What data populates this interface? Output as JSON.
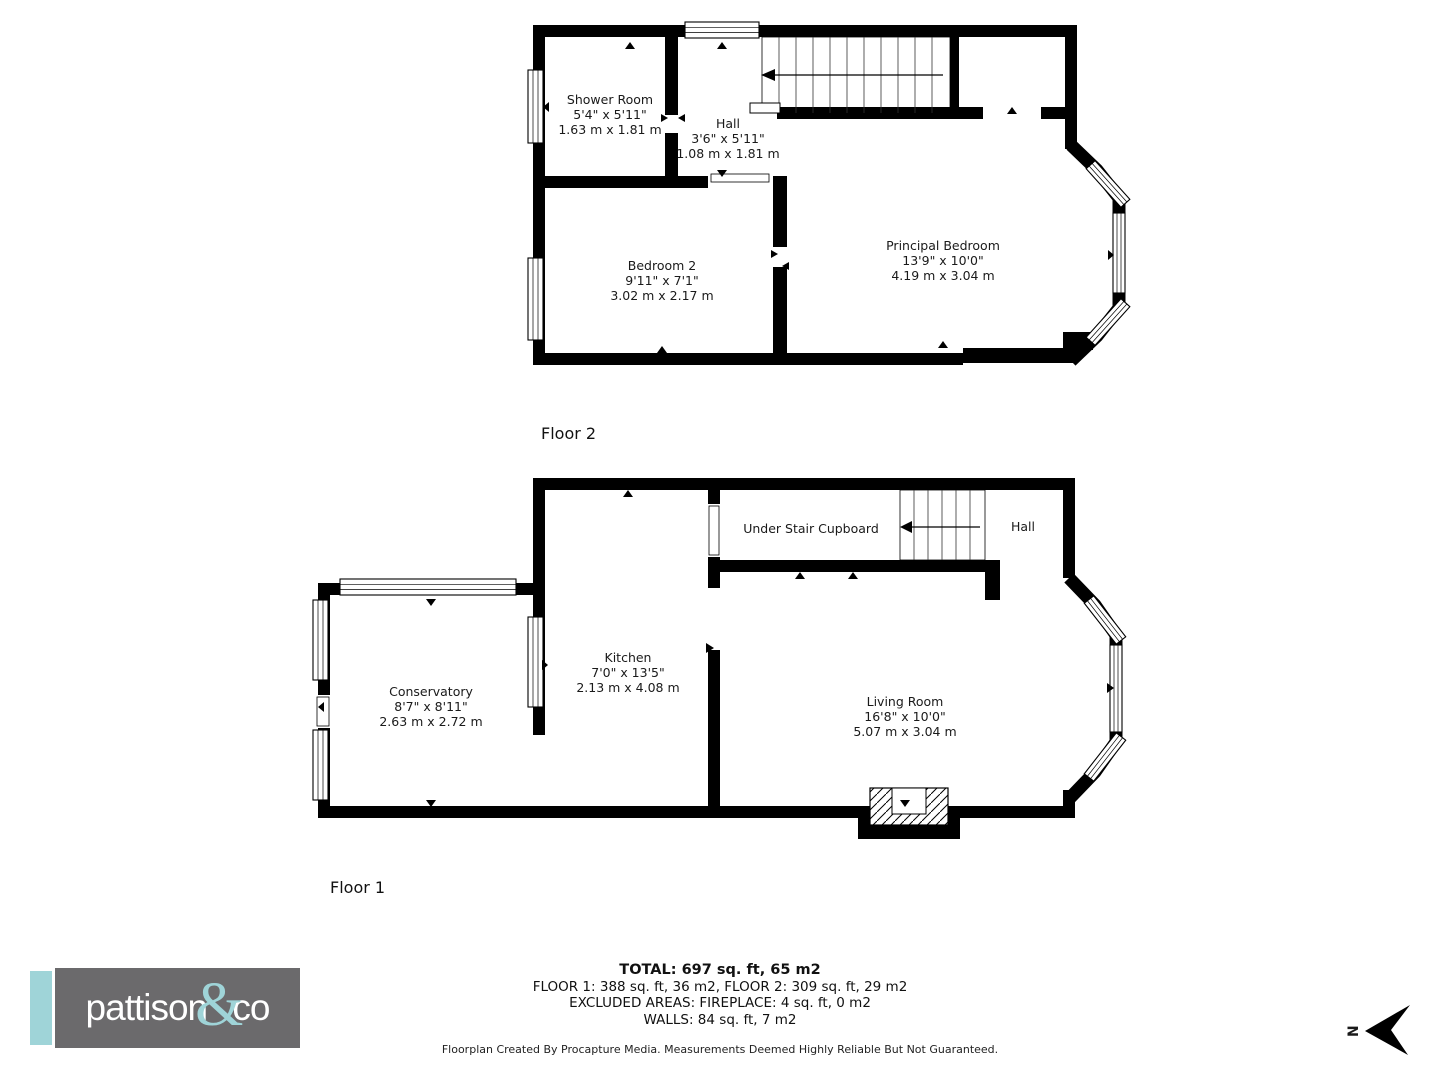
{
  "floor2": {
    "label": "Floor 2",
    "rooms": [
      {
        "name": "Shower Room",
        "imperial": "5'4\" x 5'11\"",
        "metric": "1.63 m x 1.81 m"
      },
      {
        "name": "Hall",
        "imperial": "3'6\" x 5'11\"",
        "metric": "1.08 m x 1.81 m"
      },
      {
        "name": "Bedroom 2",
        "imperial": "9'11\" x 7'1\"",
        "metric": "3.02 m x 2.17 m"
      },
      {
        "name": "Principal Bedroom",
        "imperial": "13'9\" x 10'0\"",
        "metric": "4.19 m x 3.04 m"
      }
    ]
  },
  "floor1": {
    "label": "Floor 1",
    "rooms": [
      {
        "name": "Conservatory",
        "imperial": "8'7\" x 8'11\"",
        "metric": "2.63 m x 2.72 m"
      },
      {
        "name": "Kitchen",
        "imperial": "7'0\" x 13'5\"",
        "metric": "2.13 m x 4.08 m"
      },
      {
        "name": "Under Stair Cupboard"
      },
      {
        "name": "Hall"
      },
      {
        "name": "Living Room",
        "imperial": "16'8\" x 10'0\"",
        "metric": "5.07 m x 3.04 m"
      }
    ]
  },
  "summary": {
    "total": "TOTAL: 697 sq. ft, 65 m2",
    "floors": "FLOOR 1: 388 sq. ft, 36 m2, FLOOR 2: 309 sq. ft, 29 m2",
    "excluded": "EXCLUDED AREAS: FIREPLACE: 4 sq. ft, 0 m2",
    "walls": "WALLS: 84 sq. ft, 7 m2"
  },
  "footer": {
    "disclaimer": "Floorplan Created By Procapture Media. Measurements Deemed Highly Reliable But Not Guaranteed."
  },
  "logo": {
    "brand_left": "pattison",
    "brand_amp": "&",
    "brand_right": "co",
    "accent_color": "#9fd4d8",
    "bg_color": "#6b6a6c"
  },
  "compass": {
    "north_label": "N"
  }
}
